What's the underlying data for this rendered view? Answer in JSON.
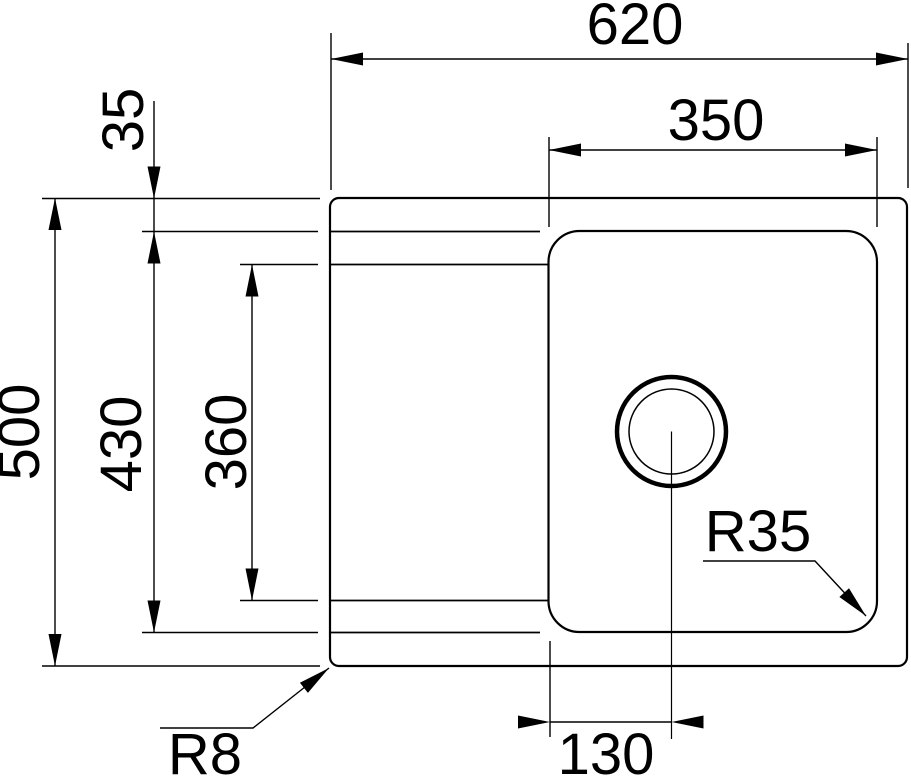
{
  "drawing": {
    "type": "technical-drawing",
    "subject": "sink-top-view",
    "colors": {
      "line": "#000000",
      "background": "#ffffff"
    },
    "dims": {
      "overall_width": "620",
      "bowl_width": "350",
      "rim_inset": "35",
      "overall_depth": "500",
      "basin_length": "430",
      "drainer_length": "360",
      "drain_offset": "130",
      "bowl_corner_radius": "R35",
      "outer_corner_radius": "R8"
    }
  }
}
